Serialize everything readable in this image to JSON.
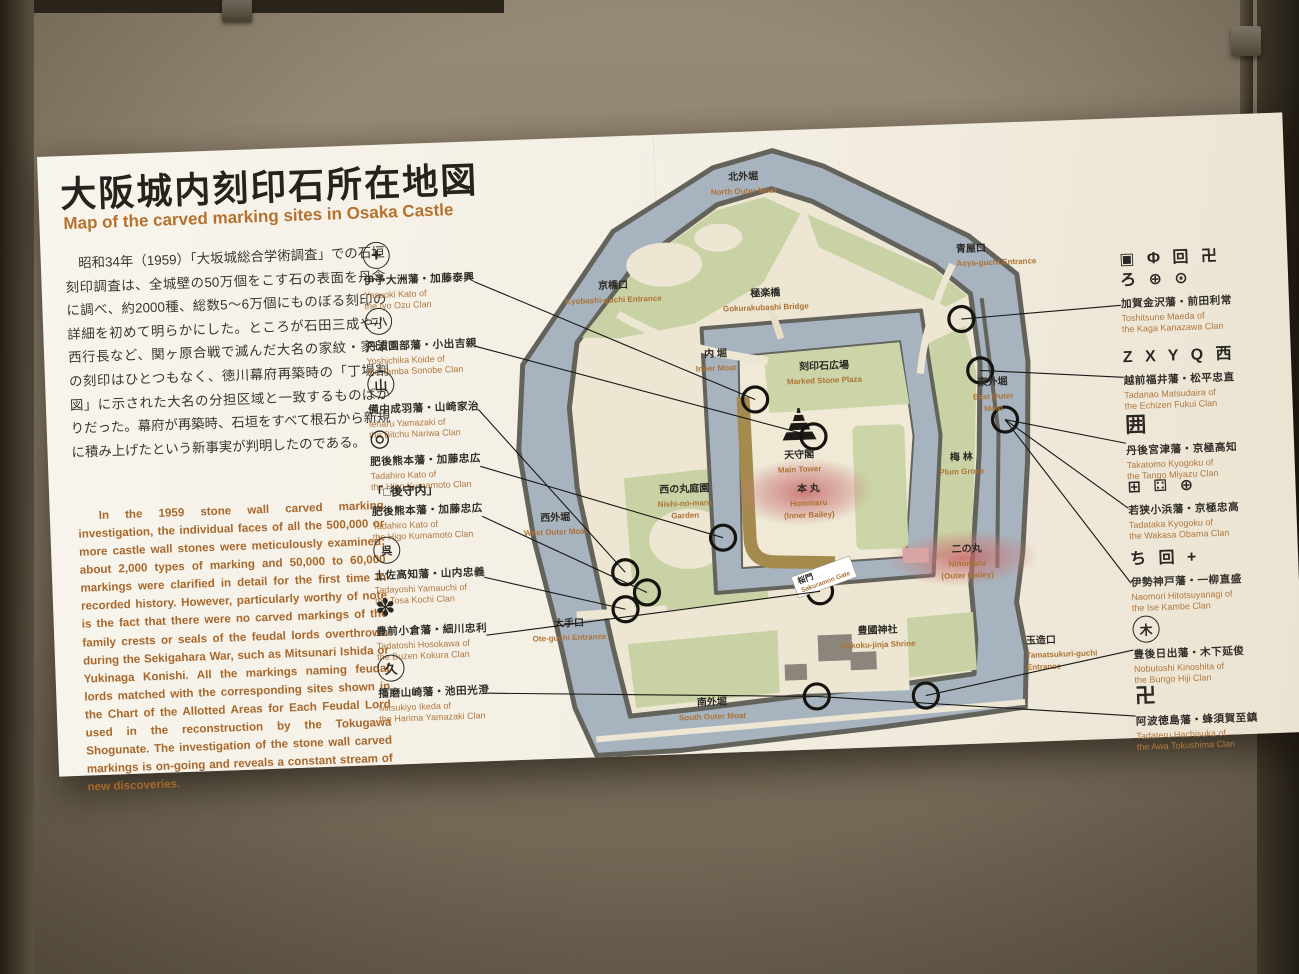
{
  "board": {
    "title_ja": "大阪城内刻印石所在地図",
    "title_en": "Map of the carved marking sites in Osaka Castle",
    "intro_ja": "昭和34年（1959）「大坂城総合学術調査」での石垣刻印調査は、全城壁の50万個をこす石の表面を丹念に調べ、約2000種、総数5〜6万個にものぼる刻印の詳細を初めて明らかにした。ところが石田三成や小西行長など、関ヶ原合戦で滅んだ大名の家紋・家印の刻印はひとつもなく、徳川幕府再築時の「丁場割図」に示された大名の分担区域と一致するものばかりだった。幕府が再築時、石垣をすべて根石から新規に積み上げたという新事実が判明したのである。",
    "intro_ja_ruby": {
      "text": "丁場割図",
      "ruby": "ちょうばわりず"
    },
    "intro_en": "In the 1959 stone wall carved marking investigation, the individual faces of all the 500,000 or more castle wall stones were meticulously examined; about 2,000 types of marking and 50,000 to 60,000 markings were clarified in detail for the first time in recorded history. However, particularly worthy of note is the fact that there were no carved markings of the family crests or seals of the feudal lords overthrown during the Sekigahara War, such as Mitsunari Ishida or Yukinaga Konishi. All the markings naming feudal lords matched with the corresponding sites shown in the Chart of the Allotted Areas for Each Feudal Lord used in the reconstruction by the Tokugawa Shogunate. The investigation of the stone wall carved markings is on-going and reveals a constant stream of new discoveries."
  },
  "legend_left": [
    {
      "mark": "+",
      "ja": "伊予大洲藩・加藤泰興",
      "en": "Yasuoki Kato of\nthe Iyo Ozu Clan"
    },
    {
      "mark": "二八",
      "ja": "丹波園部藩・小出吉親",
      "en": "Yoshichika Koide of\nthe Tamba Sonobe Clan"
    },
    {
      "mark": "山",
      "ja": "備中成羽藩・山崎家治",
      "en": "Ieharu Yamazaki of\nthe Bitchu Nariwa Clan"
    },
    {
      "mark": "◎",
      "ja": "肥後熊本藩・加藤忠広",
      "en": "Tadahiro Kato of\nthe Higo Kumamoto Clan"
    },
    {
      "mark": "「□後守内」",
      "ja": "肥後熊本藩・加藤忠広",
      "en": "Tadahiro Kato of\nthe Higo Kumamoto Clan"
    },
    {
      "mark": "呉",
      "ja": "土佐高知藩・山内忠義",
      "en": "Tadayoshi Yamauchi of\nthe Tosa Kochi Clan"
    },
    {
      "mark": "✽",
      "ja": "豊前小倉藩・細川忠利",
      "en": "Tadatoshi Hosokawa of\nthe Buzen Kokura Clan"
    },
    {
      "mark": "久",
      "ja": "播磨山崎藩・池田光澄",
      "en": "Mitsukiyo Ikeda of\nthe Harima Yamazaki Clan"
    }
  ],
  "legend_right": [
    {
      "marks": "▣ Φ 回 卍\nろ ⊕ ⊙",
      "ja": "加賀金沢藩・前田利常",
      "en": "Toshitsune Maeda of\nthe Kaga Kanazawa Clan"
    },
    {
      "marks": "Z X Y Q 西",
      "ja": "越前福井藩・松平忠直",
      "en": "Tadanao Matsudaira of\nthe Echizen Fukui Clan"
    },
    {
      "marks": "囲",
      "ja": "丹後宮津藩・京極高知",
      "en": "Takatomo Kyogoku of\nthe Tango Miyazu Clan"
    },
    {
      "marks": "⊞ ⚃ ⊕",
      "ja": "若狭小浜藩・京極忠高",
      "en": "Tadataka Kyogoku of\nthe Wakasa Obama Clan"
    },
    {
      "marks": "ち 回 +",
      "ja": "伊勢神戸藩・一柳直盛",
      "en": "Naomori Hitotsuyanagi of\nthe Ise Kambe Clan"
    },
    {
      "marks": "木",
      "ja": "豊後日出藩・木下延俊",
      "en": "Nobutoshi Kinoshita of\nthe Bungo Hiji Clan"
    },
    {
      "marks": "卍",
      "ja": "阿波徳島藩・蜂須賀至鎮",
      "en": "Tadateru Hachisuka of\nthe Awa Tokushima Clan"
    }
  ],
  "map": {
    "labels": {
      "kita_sotobori": {
        "ja": "北外堀",
        "en": "North Outer Moat"
      },
      "aoya": {
        "ja": "青屋口",
        "en": "Aoya-guchi Entrance"
      },
      "kyobashi": {
        "ja": "京橋口",
        "en": "Kyobashi-guchi Entrance"
      },
      "gokuraku": {
        "ja": "極楽橋",
        "en": "Gokurakubashi Bridge"
      },
      "uchibori": {
        "ja": "内 堀",
        "en": "Inner Moat"
      },
      "kokuinseki": {
        "ja": "刻印石広場",
        "en": "Marked Stone Plaza"
      },
      "tenshukaku": {
        "ja": "天守閣",
        "en": "Main Tower"
      },
      "honmaru": {
        "ja": "本 丸",
        "en": "Hommaru",
        "en2": "(Inner Bailey)"
      },
      "higashi_sotobori": {
        "ja": "東外堀",
        "en": "East Outer",
        "en2": "Moat"
      },
      "bairin": {
        "ja": "梅 林",
        "en": "Plum Grove"
      },
      "ninomaru": {
        "ja": "二の丸",
        "en": "Ninomaru",
        "en2": "(Outer Bailey)"
      },
      "nishinomaru_teien": {
        "ja": "西の丸庭園",
        "en": "Nishi-no-maru",
        "en2": "Garden"
      },
      "nishi_sotobori": {
        "ja": "西外堀",
        "en": "West Outer Moat"
      },
      "ote": {
        "ja": "大手口",
        "en": "Ote-guchi Entrance"
      },
      "sakuramon": {
        "ja": "桜門",
        "en": "Sakuramon Gate"
      },
      "hokoku": {
        "ja": "豊國神社",
        "en": "Hokoku-jinja Shrine"
      },
      "tamatsukuri": {
        "ja": "玉造口",
        "en": "Tamatsukuri-guchi",
        "en2": "Entrance"
      },
      "minami_sotobori": {
        "ja": "南外堀",
        "en": "South Outer Moat"
      }
    }
  },
  "colors": {
    "accent_orange": "#b5722e",
    "moat_blue": "#a7b4bf",
    "bank_gray": "#63635b",
    "land_green": "#c9d2a4",
    "ground_cream": "#ece6d2",
    "highlight_red": "#c35f5f",
    "stone_brown": "#a58a4e"
  }
}
